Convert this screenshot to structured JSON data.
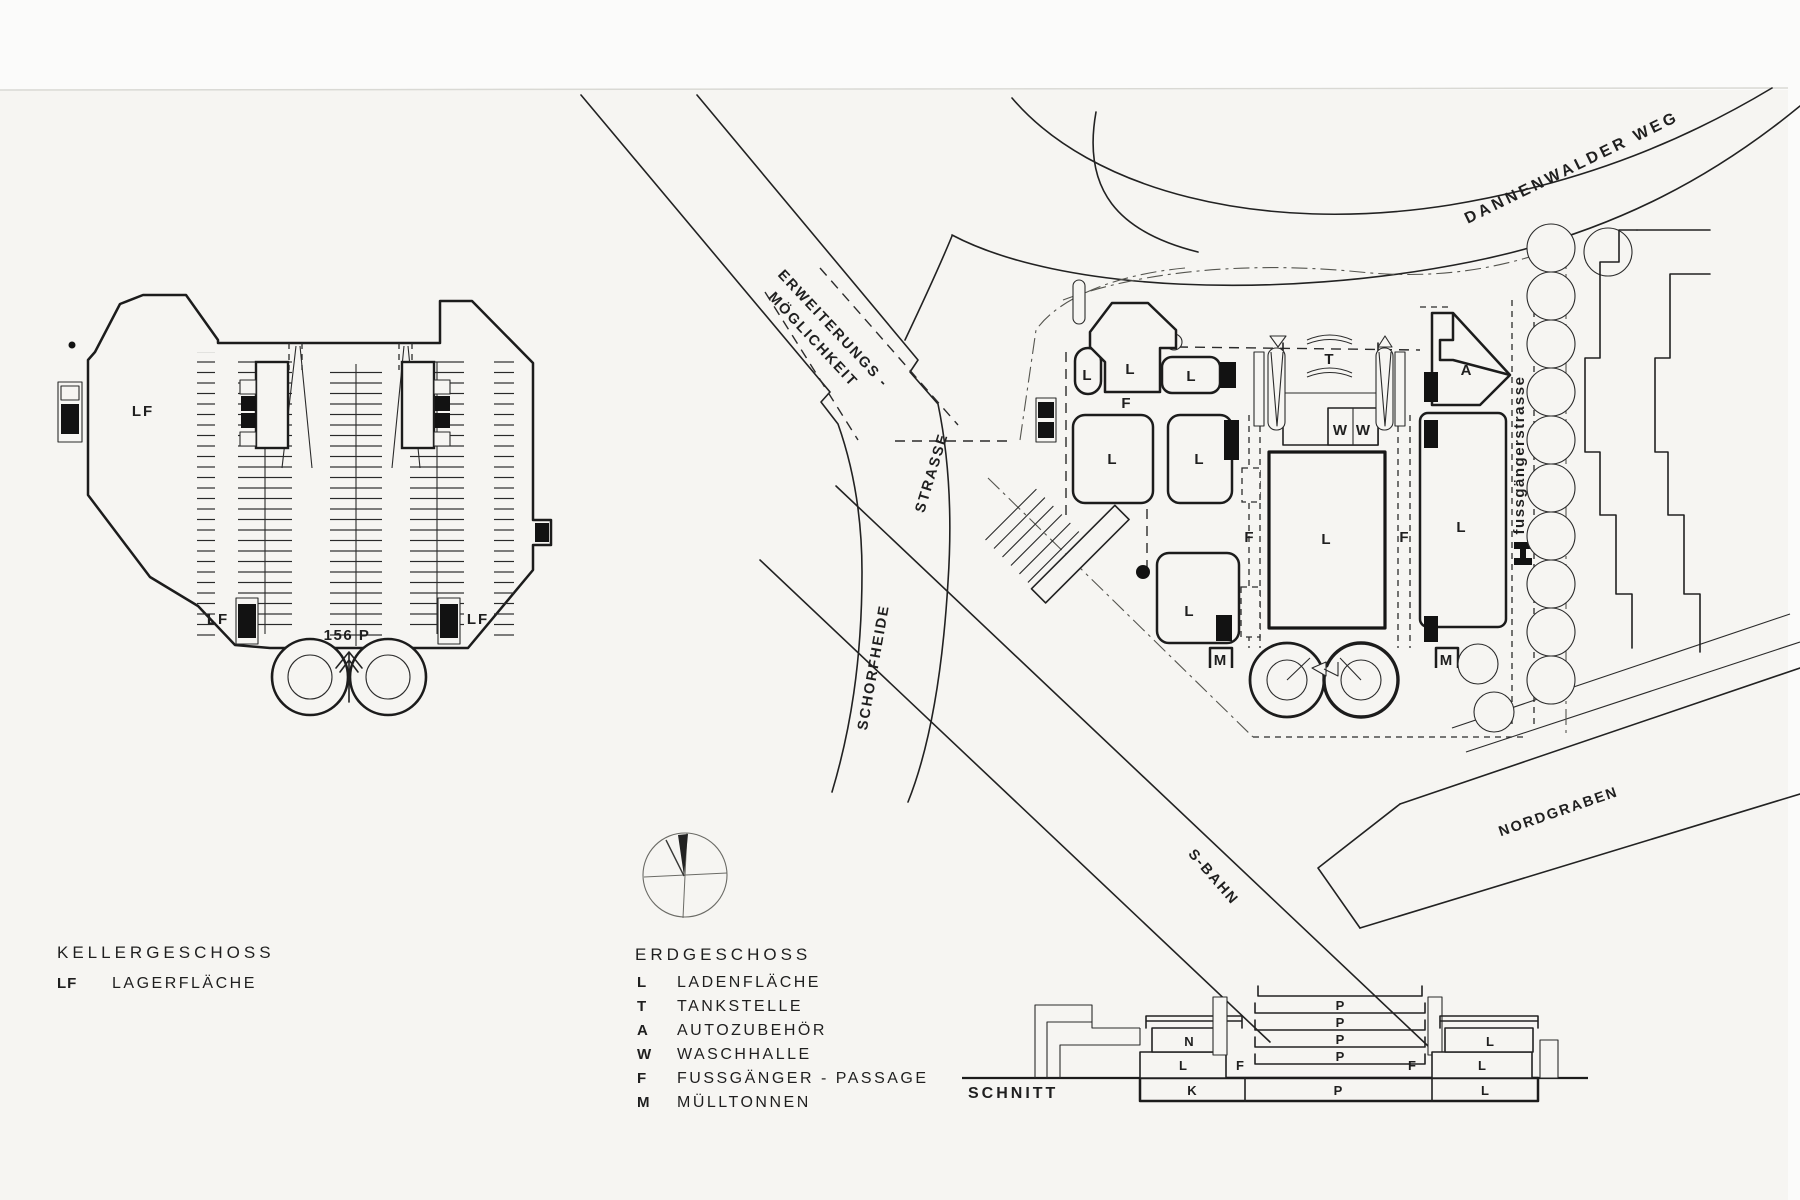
{
  "palette": {
    "ink": "#1f1f1f",
    "paper": "#f6f5f2",
    "faint": "#9a9a96"
  },
  "glyphs": {
    "L": "L",
    "F": "F",
    "T": "T",
    "A": "A",
    "W": "W",
    "M": "M",
    "N": "N",
    "K": "K",
    "P": "P"
  },
  "basement_plan": {
    "lf_label": "LF",
    "capacity_label": "156 P"
  },
  "streets": {
    "dannenwalder_weg": "DANNENWALDER WEG",
    "erweiterung_line1": "ERWEITERUNGS -",
    "erweiterung_line2": "MÖGLICHKEIT",
    "strasse": "STRASSE",
    "schorfheide": "SCHORFHEIDE",
    "s_bahn": "S-BAHN",
    "nordgraben": "NORDGRABEN",
    "fussgaengerstrasse": "fussgängerstrasse"
  },
  "legend_basement": {
    "title": "KELLERGESCHOSS",
    "items": [
      {
        "key": "LF",
        "label": "LAGERFLÄCHE"
      }
    ]
  },
  "legend_ground": {
    "title": "ERDGESCHOSS",
    "items": [
      {
        "key": "L",
        "label": "LADENFLÄCHE"
      },
      {
        "key": "T",
        "label": "TANKSTELLE"
      },
      {
        "key": "A",
        "label": "AUTOZUBEHÖR"
      },
      {
        "key": "W",
        "label": "WASCHHALLE"
      },
      {
        "key": "F",
        "label": "FUSSGÄNGER - PASSAGE"
      },
      {
        "key": "M",
        "label": "MÜLLTONNEN"
      }
    ]
  },
  "section": {
    "title": "SCHNITT"
  }
}
